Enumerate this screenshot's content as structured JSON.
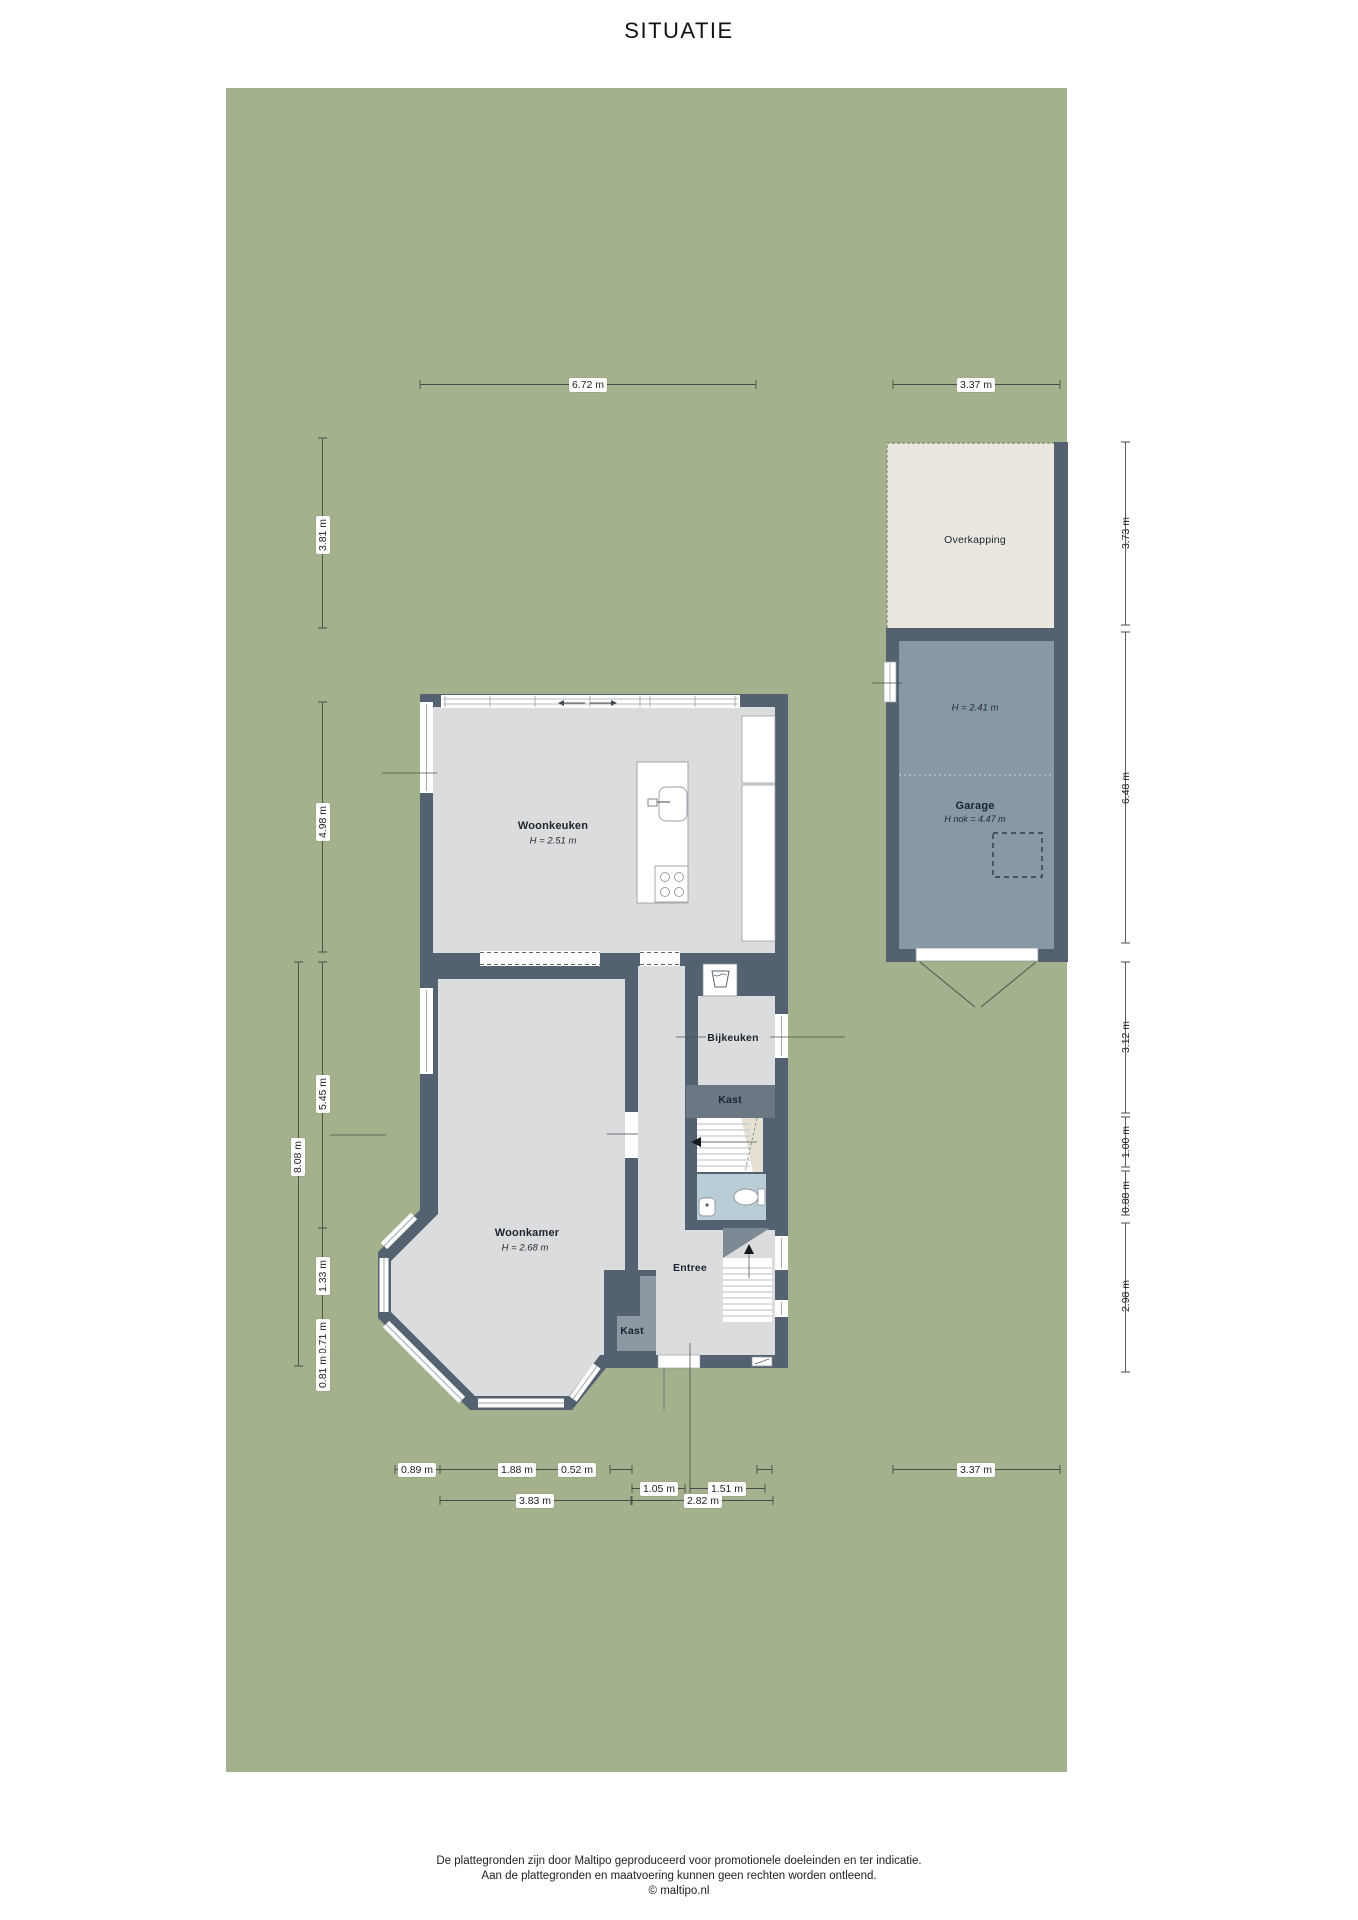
{
  "title": "SITUATIE",
  "rooms": {
    "woonkeuken": {
      "name": "Woonkeuken",
      "height": "H = 2.51 m"
    },
    "woonkamer": {
      "name": "Woonkamer",
      "height": "H = 2.68 m"
    },
    "bijkeuken": {
      "name": "Bijkeuken"
    },
    "kast_hal": {
      "name": "Kast"
    },
    "kast_woonkamer": {
      "name": "Kast"
    },
    "entree": {
      "name": "Entree"
    },
    "garage": {
      "name": "Garage",
      "height": "H = 2.41 m",
      "ridge_height": "H nok = 4.47 m"
    },
    "overkapping": {
      "name": "Overkapping"
    }
  },
  "dimensions": {
    "top": [
      "6.72 m",
      "3.37 m"
    ],
    "left": [
      "3.81 m",
      "4.98 m",
      "5.45 m",
      "8.08 m",
      "1.33 m",
      "0.71 m",
      "0.81 m"
    ],
    "right": [
      "3.73 m",
      "6.48 m",
      "3.12 m",
      "1.00 m",
      "0.88 m",
      "2.98 m"
    ],
    "bottom": [
      "0.89 m",
      "1.88 m",
      "0.52 m",
      "1.05 m",
      "1.51 m",
      "3.83 m",
      "2.82 m",
      "3.37 m"
    ]
  },
  "footer": {
    "line1": "De plattegronden zijn door Maltipo geproduceerd voor promotionele doeleinden en ter indicatie.",
    "line2": "Aan de plattegronden en maatvoering kunnen geen rechten worden ontleend.",
    "line3": "© maltipo.nl"
  },
  "colors": {
    "plot_green": "#a4b18d",
    "wall_dark": "#536170",
    "floor_gray": "#dbdcdd",
    "garage_floor": "#8798a6",
    "bathroom_blue": "#b9cdd6",
    "overkapping_cream": "#eae7df",
    "closet_gray": "#8d98a2",
    "closet_band": "#6b7883",
    "stairs_beige": "#e6e0d4"
  }
}
